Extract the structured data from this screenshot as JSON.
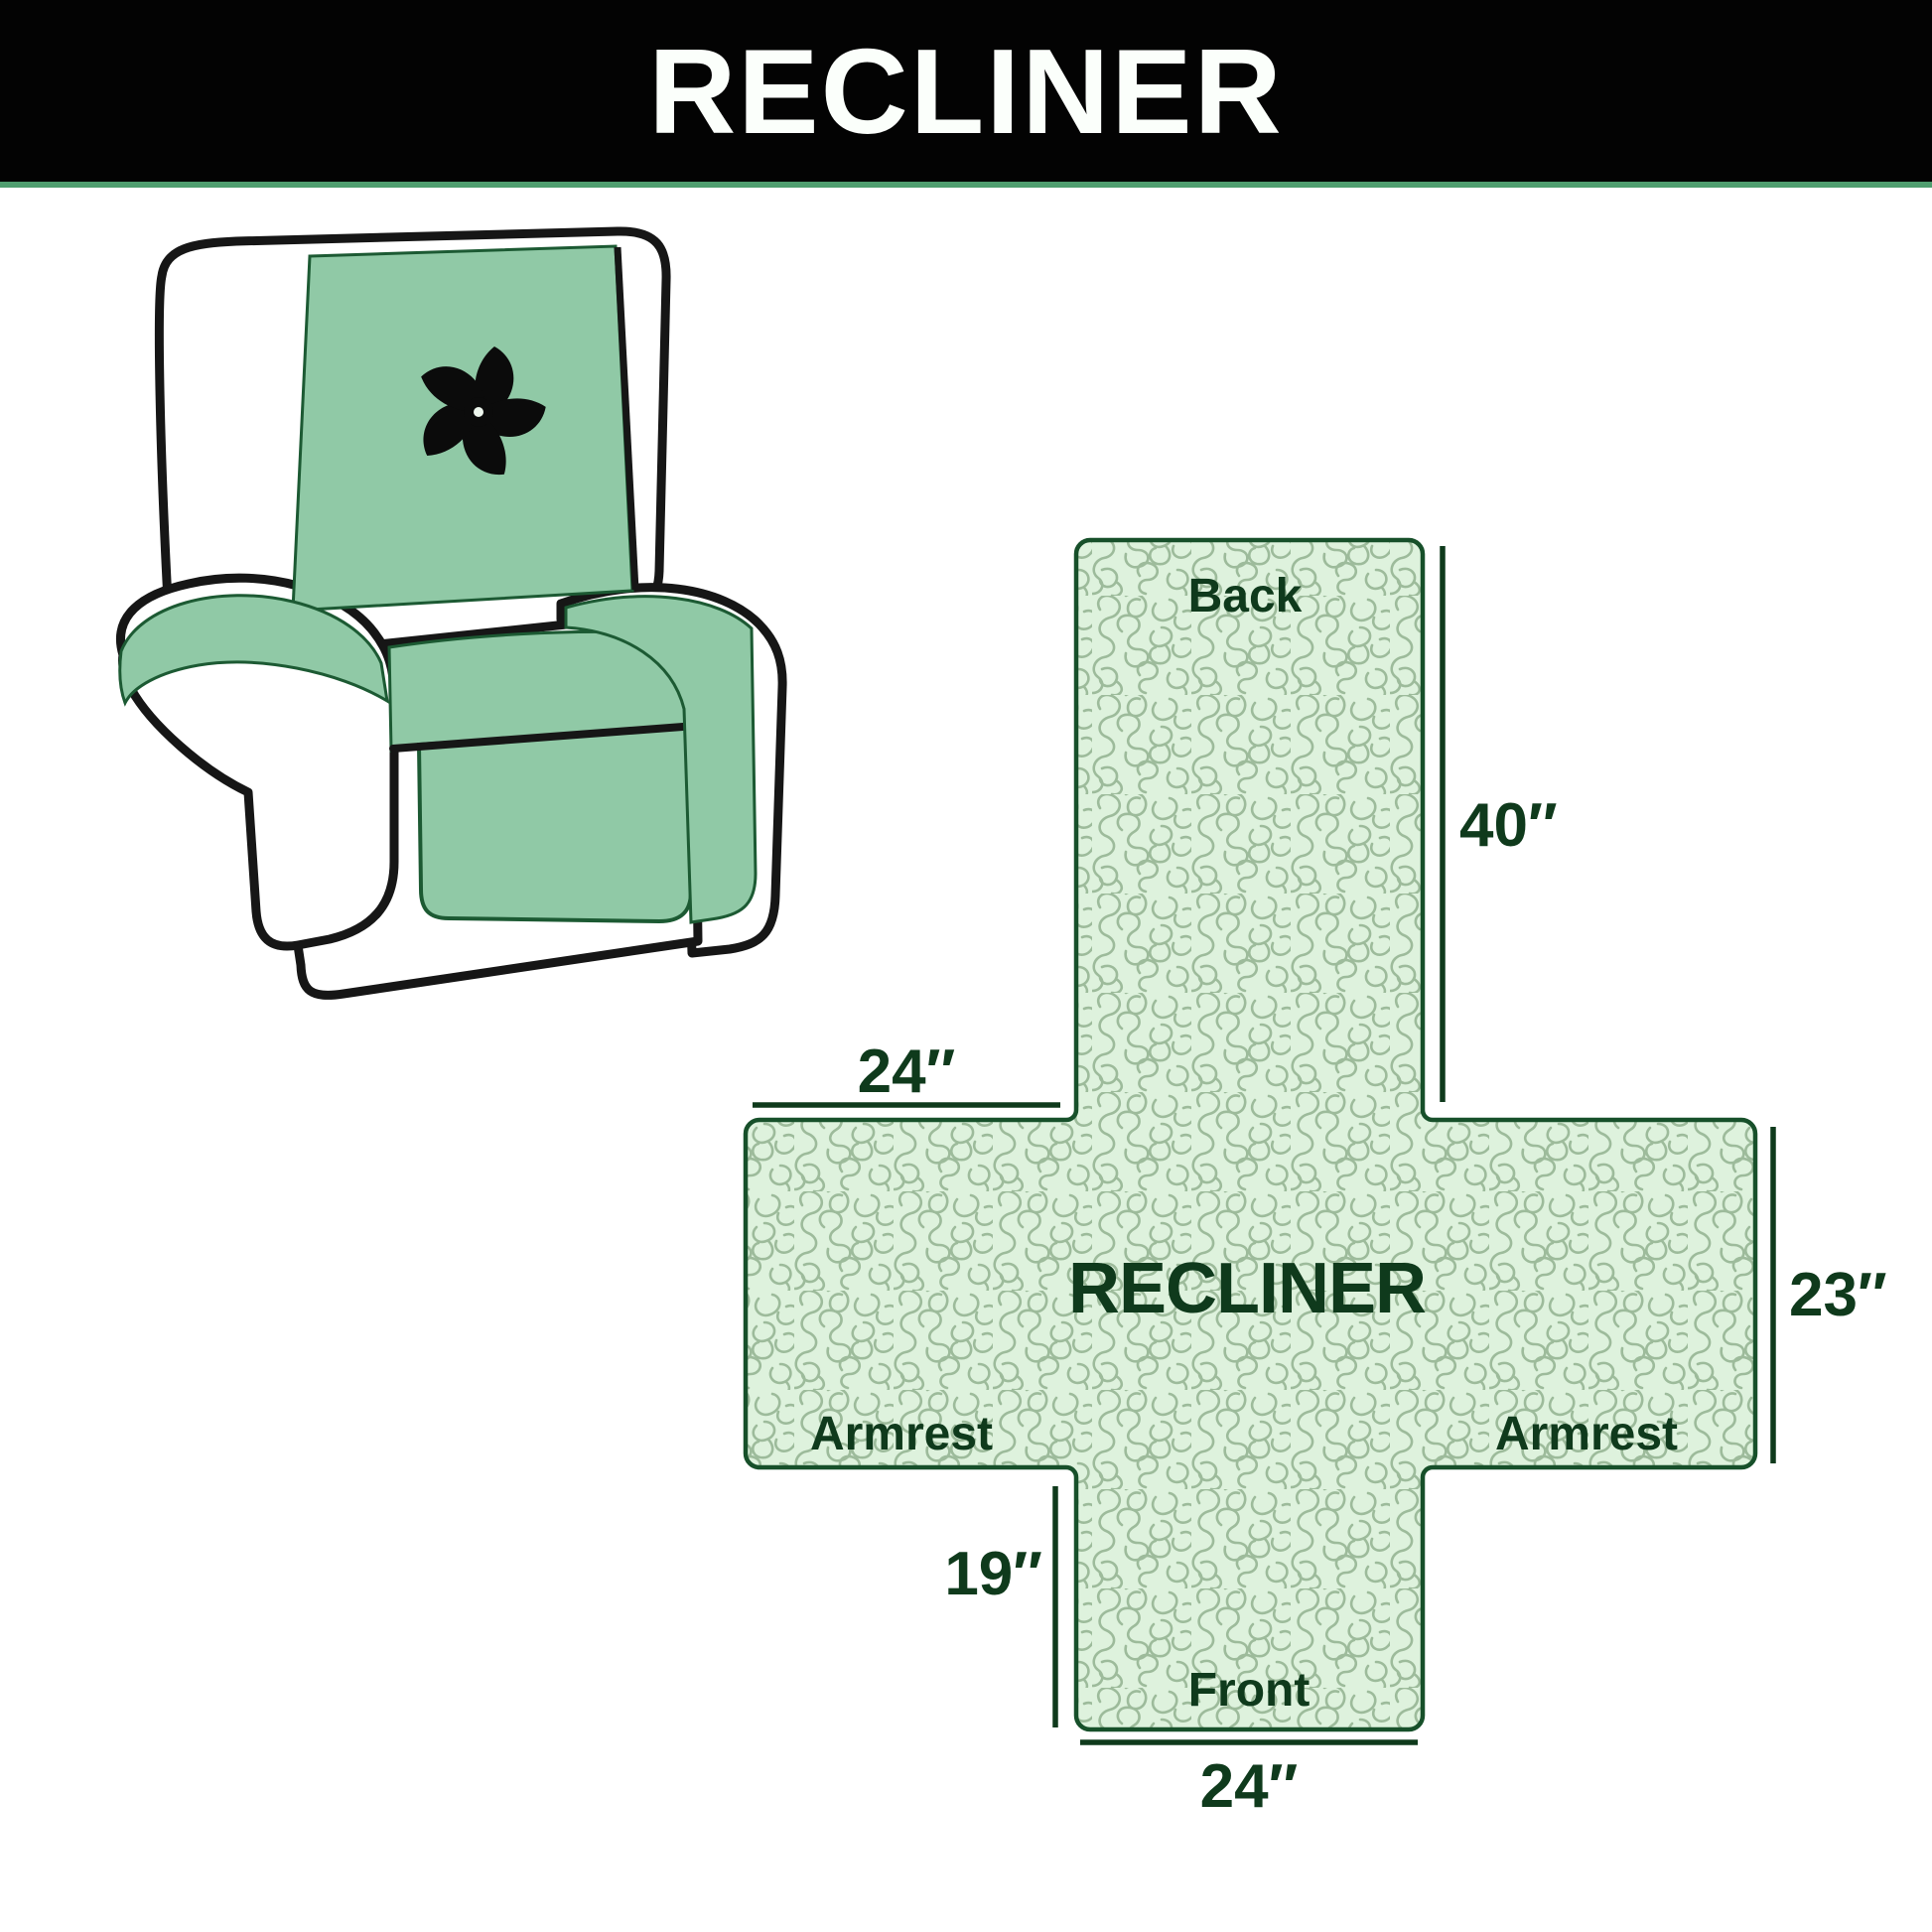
{
  "header": {
    "title": "RECLINER"
  },
  "illustration": {
    "name": "recliner-armchair-with-quilted-cover",
    "logo_icon": "fan-pinwheel",
    "cover_color": "#90c9a6",
    "outline_color": "#161616",
    "cover_edge_color": "#1c5a33"
  },
  "diagram": {
    "center_label": "RECLINER",
    "back_label": "Back",
    "front_label": "Front",
    "armrest_left_label": "Armrest",
    "armrest_right_label": "Armrest",
    "dim_back_height": "40″",
    "dim_armrest_top_width": "24″",
    "dim_armrest_side_height": "23″",
    "dim_front_flap_height": "19″",
    "dim_front_width": "24″",
    "fill_color": "#def2dd",
    "pattern_line_color": "#9dbb9b",
    "border_color": "#17502a",
    "label_color": "#0f3a1c"
  },
  "page": {
    "background": "#ffffff",
    "header_background": "#030303",
    "header_text_color": "#fbfffb",
    "accent_line_color": "#4f9e6f"
  }
}
